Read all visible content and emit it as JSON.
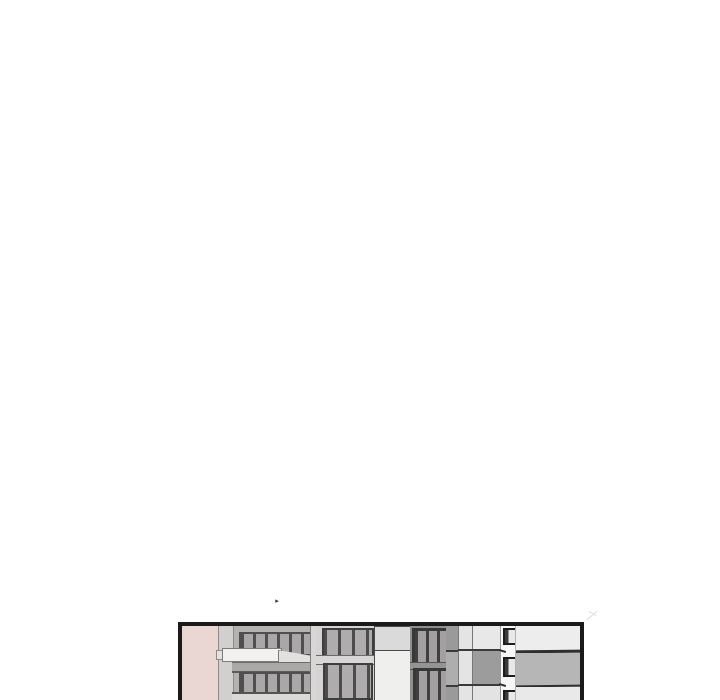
{
  "page": {
    "background_color": "#ffffff",
    "cursor_mark_glyph": "▸"
  },
  "panel": {
    "kind": "comic-panel-building-facades",
    "border_color": "#1a1a1a",
    "palette": {
      "pink_wall": "#ead7d3",
      "facade_gray": "#b4b1b1",
      "facade_light": "#d5d3d3",
      "window_pane": "#a9a7a7",
      "window_mullion": "#4a4a4a",
      "window_frame_dark": "#383838",
      "ledge_white": "#f2f1f0",
      "light_cell_top": "#dadada",
      "light_cell_bottom": "#efefee",
      "building_c_surround": "#8f8f8f",
      "edge_strip_gray": "#9a9a9a",
      "grid_column_light": "#e4e4e4",
      "grid_cell_light": "#e8e8e8",
      "grid_cell_dark": "#9c9c9c",
      "grid_cell_bottom": "#e3e3e3",
      "corner_wall_white": "#f7f7f7",
      "side_band_light": "#ededed",
      "side_band_gray": "#b6b6b6",
      "side_band_bottom": "#e9e9e9"
    }
  }
}
